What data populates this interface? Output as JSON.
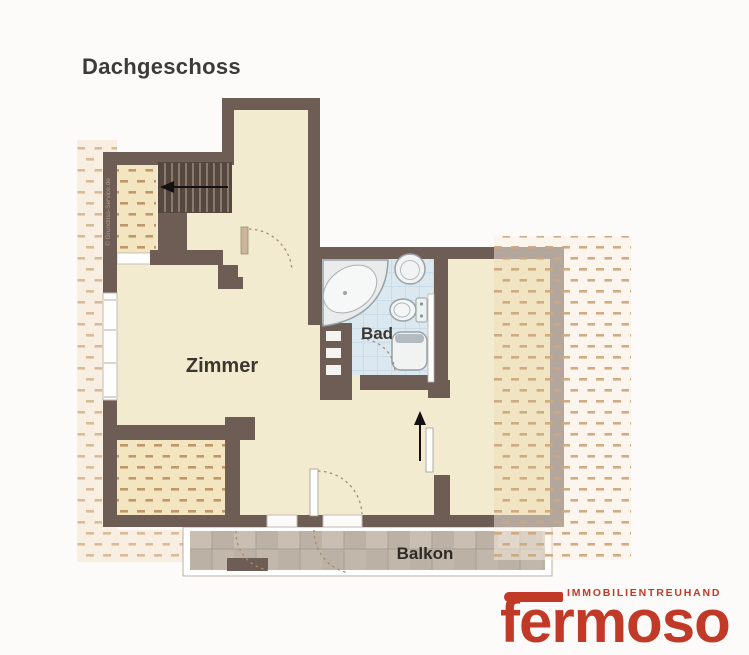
{
  "title": "Dachgeschoss",
  "plan": {
    "rooms": {
      "zimmer": "Zimmer",
      "bad": "Bad",
      "balkon": "Balkon"
    },
    "watermark": "© Grundriss-Service.de",
    "colors": {
      "wall": "#6d5d55",
      "floor": "#f3ebcf",
      "bath_floor": "#dce8f0",
      "hatch_dash_interior": "#c0966a",
      "hatch_dash_exterior": "#d9bb98",
      "balcony_tile": "#bcb1a5",
      "label": "#3b3630"
    }
  },
  "logo": {
    "tagline": "IMMOBILIENTREUHAND",
    "brand": "fermoso",
    "color": "#c13a28"
  }
}
